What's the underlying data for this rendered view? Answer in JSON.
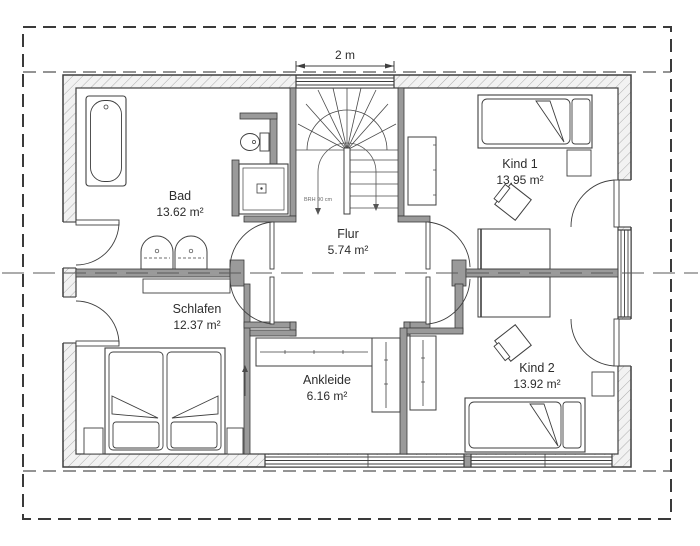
{
  "plan": {
    "type": "floor-plan",
    "dimension_label": "2 m",
    "sill_note": "BRH 90 cm",
    "rooms": {
      "bad": {
        "name": "Bad",
        "area": "13.62 m²"
      },
      "kind1": {
        "name": "Kind 1",
        "area": "13.95 m²"
      },
      "flur": {
        "name": "Flur",
        "area": "5.74 m²"
      },
      "schlafen": {
        "name": "Schlafen",
        "area": "12.37 m²"
      },
      "ankleide": {
        "name": "Ankleide",
        "area": "6.16 m²"
      },
      "kind2": {
        "name": "Kind 2",
        "area": "13.92 m²"
      }
    },
    "colors": {
      "line": "#3f3f3f",
      "interior_wall_fill": "#9a9a9a",
      "text": "#2d2d2d",
      "dashed_line": "#4a4a4a"
    }
  }
}
